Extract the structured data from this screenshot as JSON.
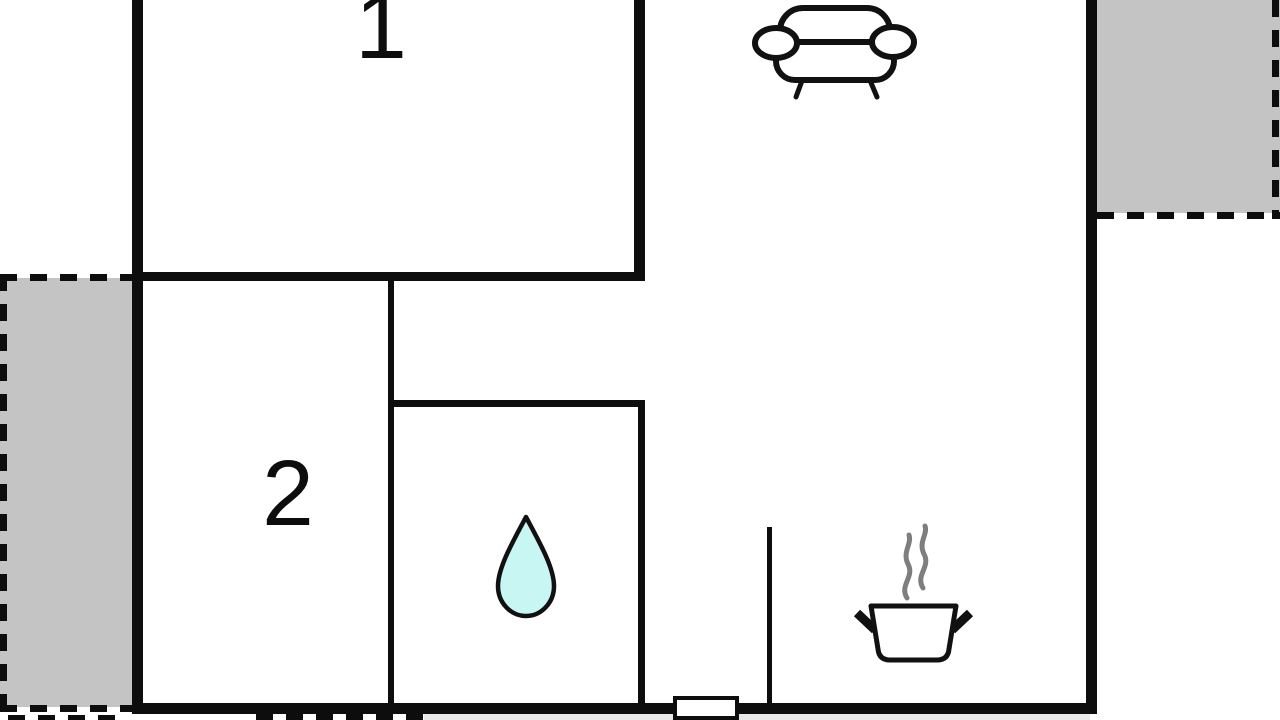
{
  "title": "apartment-floor-plan",
  "rooms": [
    {
      "label": "1"
    },
    {
      "label": "2"
    }
  ],
  "icons": {
    "sofa": "sofa-icon",
    "water_drop": "water-drop-icon",
    "cooking_pot": "cooking-pot-icon",
    "steam": "steam-icon"
  },
  "colors": {
    "wall": "#0d0d0d",
    "outline": "#111111",
    "terrace_fill": "#c4c4c4",
    "drop_fill": "#c7f6f3",
    "steam": "#7e7e7e",
    "bottom_strip": "#e9e9e9",
    "background": "#ffffff"
  }
}
